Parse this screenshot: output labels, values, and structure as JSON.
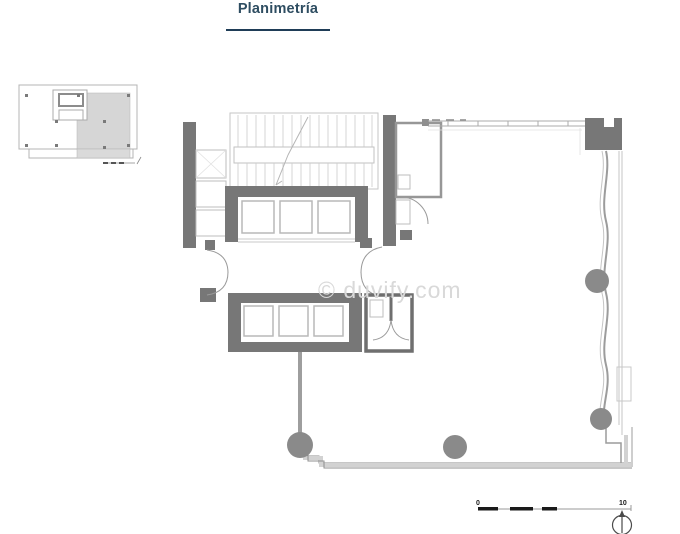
{
  "header": {
    "title": "Planimetría"
  },
  "watermark": {
    "text": "© duvify.com"
  },
  "plan": {
    "scale_bar": {
      "start": "0",
      "end": "10"
    }
  },
  "icons": {
    "north_arrow": "north-arrow"
  },
  "colors": {
    "title": "#2e4d61",
    "divider": "#1f3d57",
    "wall_dark": "#777777",
    "wall_mid": "#8f8f8f",
    "wall_light": "#b9b9b9",
    "line_light": "#c9c9c9",
    "column": "#8a8a8a",
    "shade": "#d6d6d6",
    "watermark": "#d9d9d9",
    "scale_ink": "#1a1a1a",
    "background": "#ffffff"
  }
}
